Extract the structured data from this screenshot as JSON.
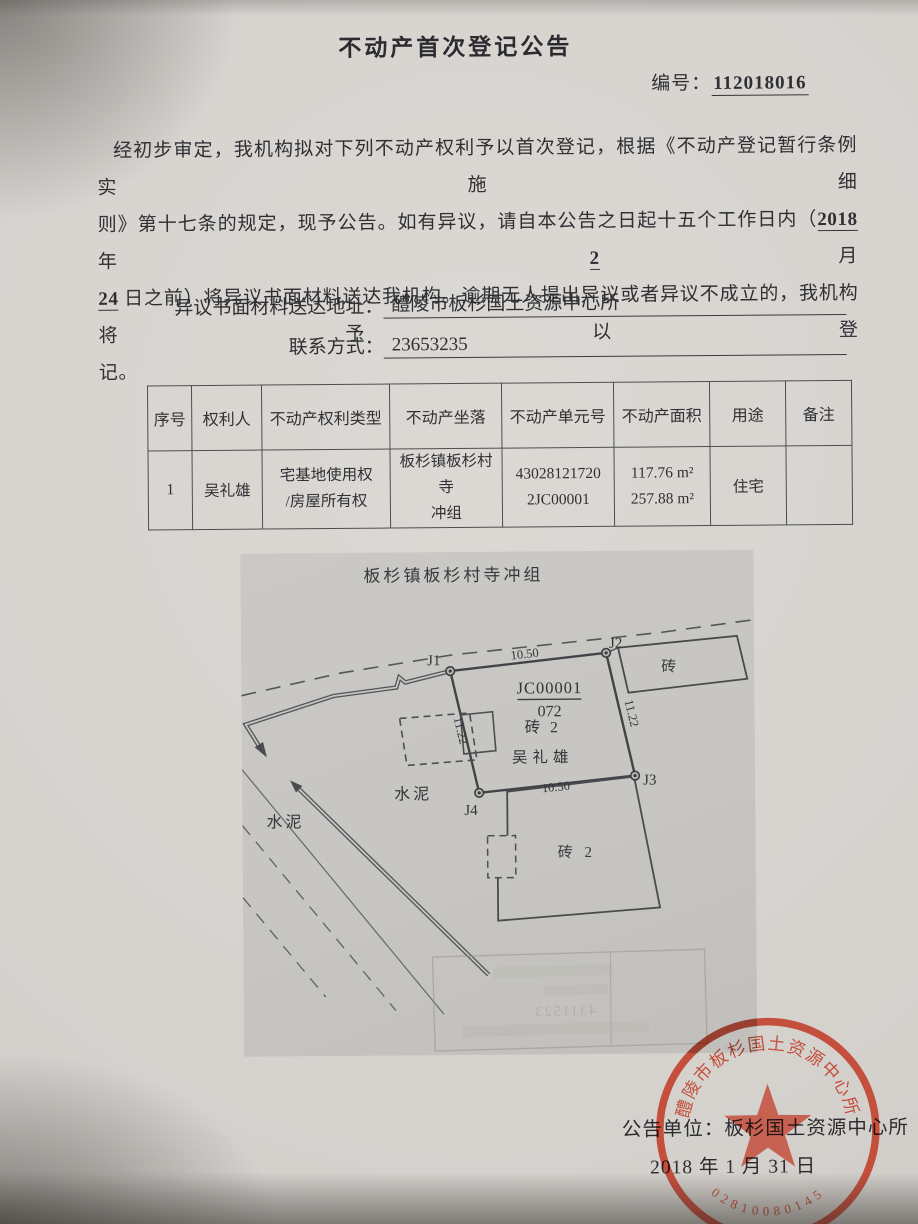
{
  "doc": {
    "title": "不动产首次登记公告",
    "no_label": "编号：",
    "no_value": "112018016",
    "para": {
      "l1": "经初步审定，我机构拟对下列不动产权利予以首次登记，根据《不动产登记暂行条例实施细",
      "l2_pre": "则》第十七条的规定，现予公告。如有异议，请自本公告之日起十五个工作日内（",
      "l2_year": "2018",
      "l2_sep1": " 年 ",
      "l2_month": "2",
      "l2_sep2": " 月",
      "l3_day": "24",
      "l3_rest": " 日之前）将异议书面材料送达我机构。逾期无人提出异议或者异议不成立的，我机构将予以登",
      "l4": "记。"
    },
    "address_label": "异议书面材料送达地址：",
    "address_value": "醴陵市板杉国土资源中心所",
    "contact_label": "联系方式：",
    "contact_value": "23653235"
  },
  "table": {
    "headers": [
      "序号",
      "权利人",
      "不动产权利类型",
      "不动产坐落",
      "不动产单元号",
      "不动产面积",
      "用途",
      "备注"
    ],
    "row1": {
      "seq": "1",
      "holder": "吴礼雄",
      "right1": "宅基地使用权",
      "right2": "/房屋所有权",
      "loc1": "板杉镇板杉村寺",
      "loc2": "冲组",
      "unit1": "43028121720",
      "unit2": "2JC00001",
      "area1": "117.76 m²",
      "area2": "257.88 m²",
      "use": "住宅",
      "remark": ""
    }
  },
  "plan": {
    "title": "板杉镇板杉村寺冲组",
    "j1": "J1",
    "j2": "J2",
    "j3": "J3",
    "j4": "J4",
    "dim_top": "10.50",
    "dim_bottom": "10.50",
    "dim_left": "11.22",
    "dim_right": "11.22",
    "parcel_no": "JC00001",
    "parcel_sub": "072",
    "parcel_material": "砖 2",
    "owner": "吴礼雄",
    "building_east": "砖",
    "building_south": "砖 2",
    "surface_left": "水泥",
    "surface_center": "水泥",
    "bleed_text": "4311523"
  },
  "footer": {
    "unit_label": "公告单位：",
    "unit_value": "板杉国土资源中心所",
    "date": "2018 年 1 月 31 日"
  },
  "stamp": {
    "ring_text": "醴陵市板杉国土资源中心所",
    "serial": "02810080145",
    "color": "#c2402c"
  }
}
